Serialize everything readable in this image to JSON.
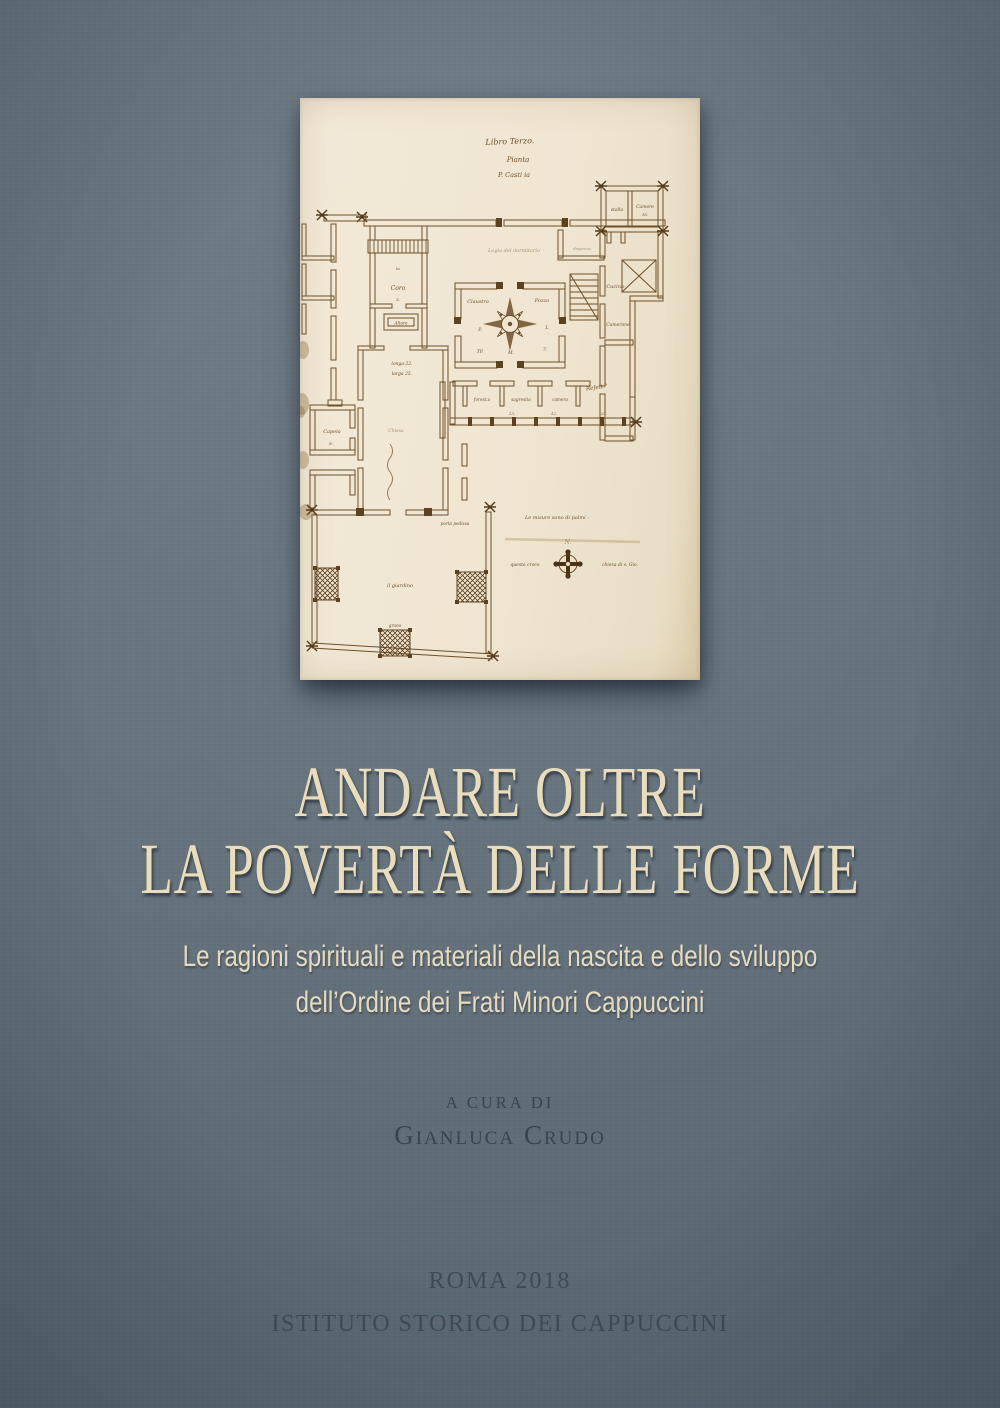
{
  "page": {
    "type": "book-cover"
  },
  "colors": {
    "background_slate": "#64717b",
    "paper_cream": "#efe5d1",
    "ink_brown": "#6e4f28",
    "title_cream": "#e9ddbd",
    "dark_text": "#3a434c"
  },
  "cover": {
    "title_line1": "ANDARE OLTRE",
    "title_line2": "LA POVERTÀ DELLE FORME",
    "subtitle_line1": "Le ragioni spirituali e materiali della nascita e dello sviluppo",
    "subtitle_line2": "dell’Ordine dei Frati Minori Cappuccini",
    "editor_prefix": "A CURA DI",
    "editor_name": "Gianluca Crudo",
    "imprint_place_year": "ROMA 2018",
    "imprint_publisher": "ISTITUTO STORICO DEI CAPPUCCINI"
  },
  "plan": {
    "labels": {
      "header1": "Libro Terzo.",
      "header2": "Pianta",
      "header3": "P. Casti ia",
      "stalla": "stalla",
      "camere": "Camere",
      "camere_num": "16.",
      "dispensa": "dispensa",
      "cucina": "Cucina-",
      "logia": "Logia del dormitorio",
      "claustro": "Claustro",
      "pozzo": "Pozzo",
      "mark_p": "P.",
      "mark_l": "L",
      "mark_tp": "TP.",
      "mark_m": "M.",
      "mark_7": "7.",
      "coro_la": "la",
      "coro": "Coro",
      "coro_s": "S.",
      "altare": "Altare",
      "dim1": "longa 22.",
      "dim2": "larga 25.",
      "chiesa": "Chiesa",
      "camerone": "Camerone",
      "refettorio": "Refett.°",
      "foresteria": "forest.a",
      "sagrestia": "sagrestia",
      "camera": "camera",
      "num13": "13.",
      "num12": "12.",
      "num25": "25.",
      "capela": "Capela",
      "capela_num": "8.",
      "porta": "porta pedissa",
      "giardino": "il giardino",
      "grano": "grano",
      "misure": "Le misure sono di palmi -",
      "faded_mark": "N.",
      "croce_left": "questa croce",
      "croce_right": "chiesa di s. Gio."
    }
  }
}
